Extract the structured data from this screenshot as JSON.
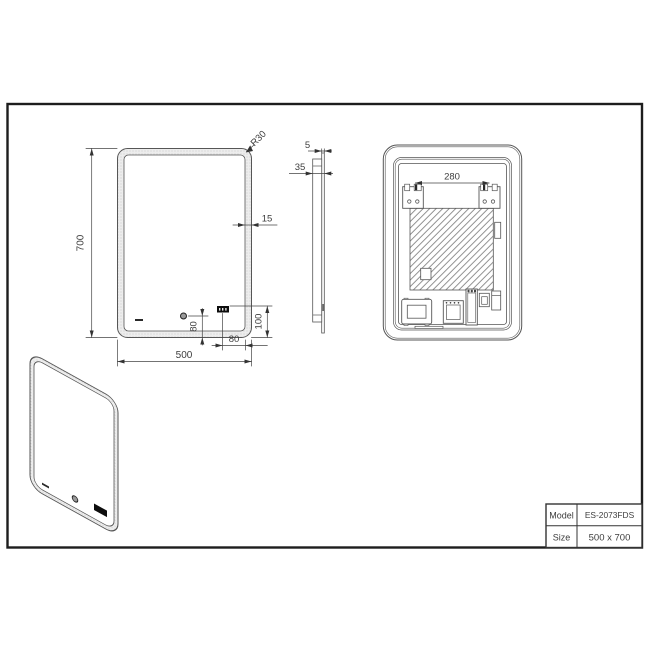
{
  "dims": {
    "mirror_height": "700",
    "mirror_width": "500",
    "corner_radius": "R30",
    "led_band_width": "15",
    "sensor_bottom_offset": "80",
    "display_right_offset": "80",
    "display_bottom_offset": "100",
    "glass_thickness": "5",
    "frame_depth": "35",
    "bracket_spacing": "280"
  },
  "title_block": {
    "rows": [
      {
        "label": "Model",
        "value": "ES-2073FDS"
      },
      {
        "label": "Size",
        "value": "500 x 700"
      }
    ]
  },
  "colors": {
    "line": "#565656",
    "dim": "#3d3d3d",
    "border": "#1d1d1d",
    "display": "#0d0d0d"
  }
}
